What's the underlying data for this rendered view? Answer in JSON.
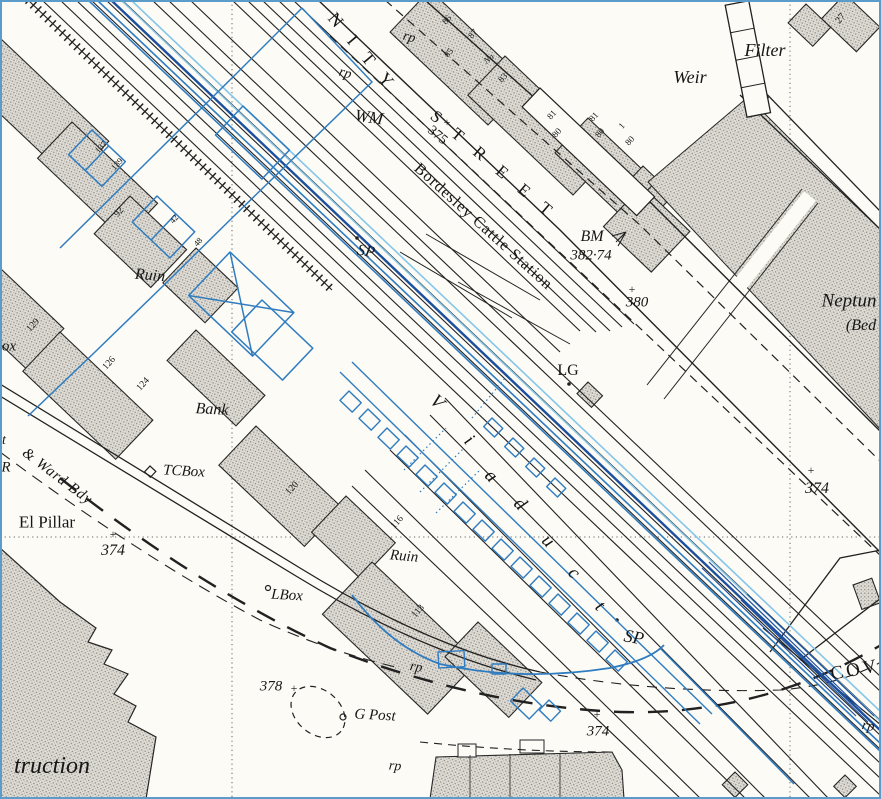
{
  "map": {
    "colors": {
      "paper": "#fcfbf6",
      "ink": "#212121",
      "overlay_blue": "#2f7cc0",
      "overlay_cyan": "#85c6e9",
      "overlay_navy": "#1c4f9d",
      "frame_blue": "#5b9ccb",
      "stipple": "#8e8c84"
    },
    "labels": [
      {
        "id": "street-name-part1",
        "t": "N I T Y",
        "x": 363,
        "y": 52,
        "r": 50,
        "s": 18,
        "i": 0,
        "ls": 6
      },
      {
        "id": "rp-1",
        "t": "rp",
        "x": 409,
        "y": 38,
        "r": 15,
        "s": 14,
        "i": 1
      },
      {
        "id": "rp-2",
        "t": "rp",
        "x": 345,
        "y": 74,
        "r": 15,
        "s": 14,
        "i": 1
      },
      {
        "id": "wm",
        "t": "WM",
        "x": 369,
        "y": 117,
        "r": 8,
        "s": 17,
        "i": 1
      },
      {
        "id": "street-name-part2",
        "t": "S T R E E T",
        "x": 494,
        "y": 165,
        "r": 40,
        "s": 17,
        "i": 0,
        "ls": 7
      },
      {
        "id": "spot-375",
        "t": "375",
        "x": 437,
        "y": 136,
        "r": 40,
        "s": 14,
        "i": 0
      },
      {
        "id": "cross-375",
        "t": "+",
        "x": 447,
        "y": 122,
        "r": 0,
        "s": 12,
        "i": 0
      },
      {
        "id": "bordesley-cattle-station",
        "t": "Bordesley Cattle Station",
        "x": 483,
        "y": 227,
        "r": 42,
        "s": 16,
        "i": 0,
        "ls": 1
      },
      {
        "id": "bm",
        "t": "BM",
        "x": 592,
        "y": 237,
        "r": 0,
        "s": 16,
        "i": 1
      },
      {
        "id": "bm-value",
        "t": "382·74",
        "x": 591,
        "y": 256,
        "r": 0,
        "s": 15,
        "i": 1
      },
      {
        "id": "spot-380",
        "t": "380",
        "x": 637,
        "y": 303,
        "r": 0,
        "s": 15,
        "i": 1
      },
      {
        "id": "cross-380",
        "t": "+",
        "x": 632,
        "y": 289,
        "r": 0,
        "s": 12,
        "i": 0
      },
      {
        "id": "weir",
        "t": "Weir",
        "x": 690,
        "y": 77,
        "r": 0,
        "s": 18,
        "i": 1
      },
      {
        "id": "filter",
        "t": "Filter",
        "x": 765,
        "y": 50,
        "r": 0,
        "s": 18,
        "i": 1
      },
      {
        "id": "no-27",
        "t": "27",
        "x": 841,
        "y": 19,
        "r": -50,
        "s": 10,
        "i": 0
      },
      {
        "id": "no-86",
        "t": "86",
        "x": 447,
        "y": 20,
        "r": -48,
        "s": 9,
        "i": 0
      },
      {
        "id": "no-85",
        "t": "85",
        "x": 449,
        "y": 53,
        "r": -48,
        "s": 9,
        "i": 0
      },
      {
        "id": "no-87",
        "t": "87",
        "x": 473,
        "y": 34,
        "r": -48,
        "s": 9,
        "i": 0
      },
      {
        "id": "no-na",
        "t": "Na",
        "x": 489,
        "y": 59,
        "r": -40,
        "s": 9,
        "i": 1
      },
      {
        "id": "no-83",
        "t": "83",
        "x": 503,
        "y": 78,
        "r": -48,
        "s": 9,
        "i": 0
      },
      {
        "id": "no-81a",
        "t": "81",
        "x": 552,
        "y": 115,
        "r": -48,
        "s": 9,
        "i": 0
      },
      {
        "id": "no-80a",
        "t": "80",
        "x": 557,
        "y": 133,
        "r": -48,
        "s": 9,
        "i": 0
      },
      {
        "id": "no-81b",
        "t": "81",
        "x": 594,
        "y": 117,
        "r": -48,
        "s": 9,
        "i": 0
      },
      {
        "id": "no-80b",
        "t": "80",
        "x": 600,
        "y": 133,
        "r": -48,
        "s": 9,
        "i": 0
      },
      {
        "id": "no-1",
        "t": "1",
        "x": 622,
        "y": 126,
        "r": -48,
        "s": 9,
        "i": 0
      },
      {
        "id": "no-80c",
        "t": "80",
        "x": 630,
        "y": 141,
        "r": -48,
        "s": 9,
        "i": 0
      },
      {
        "id": "neptun",
        "t": "Neptun",
        "x": 849,
        "y": 301,
        "r": 0,
        "s": 19,
        "i": 1
      },
      {
        "id": "bed",
        "t": "(Bed",
        "x": 861,
        "y": 326,
        "r": 0,
        "s": 16,
        "i": 1
      },
      {
        "id": "spot-374-right",
        "t": "374",
        "x": 817,
        "y": 489,
        "r": 0,
        "s": 16,
        "i": 1
      },
      {
        "id": "cross-374-right",
        "t": "+",
        "x": 811,
        "y": 470,
        "r": 0,
        "s": 12,
        "i": 0
      },
      {
        "id": "cov",
        "t": "COV",
        "x": 855,
        "y": 670,
        "r": -10,
        "s": 19,
        "i": 0,
        "ls": 3
      },
      {
        "id": "rp-5",
        "t": "rp",
        "x": 868,
        "y": 727,
        "r": 10,
        "s": 14,
        "i": 1
      },
      {
        "id": "sp-2",
        "t": "SP",
        "x": 634,
        "y": 637,
        "r": 10,
        "s": 18,
        "i": 1
      },
      {
        "id": "viaduct-v",
        "t": "V",
        "x": 437,
        "y": 402,
        "r": 45,
        "s": 19,
        "i": 1
      },
      {
        "id": "viaduct-i",
        "t": "i",
        "x": 469,
        "y": 440,
        "r": 45,
        "s": 19,
        "i": 1
      },
      {
        "id": "viaduct-a",
        "t": "a",
        "x": 491,
        "y": 476,
        "r": 45,
        "s": 19,
        "i": 1
      },
      {
        "id": "viaduct-d",
        "t": "d",
        "x": 520,
        "y": 504,
        "r": 45,
        "s": 19,
        "i": 1
      },
      {
        "id": "viaduct-u",
        "t": "u",
        "x": 548,
        "y": 541,
        "r": 45,
        "s": 19,
        "i": 1
      },
      {
        "id": "viaduct-c",
        "t": "c",
        "x": 574,
        "y": 573,
        "r": 45,
        "s": 19,
        "i": 1
      },
      {
        "id": "viaduct-t",
        "t": "t",
        "x": 600,
        "y": 606,
        "r": 45,
        "s": 19,
        "i": 1
      },
      {
        "id": "sp-1",
        "t": "SP",
        "x": 366,
        "y": 252,
        "r": 10,
        "s": 16,
        "i": 1
      },
      {
        "id": "lg",
        "t": "LG",
        "x": 568,
        "y": 371,
        "r": 0,
        "s": 16,
        "i": 0
      },
      {
        "id": "ruin-1",
        "t": "Ruin",
        "x": 150,
        "y": 276,
        "r": 5,
        "s": 16,
        "i": 1
      },
      {
        "id": "ruin-2",
        "t": "Ruin",
        "x": 404,
        "y": 557,
        "r": 5,
        "s": 15,
        "i": 1
      },
      {
        "id": "bank",
        "t": "Bank",
        "x": 212,
        "y": 410,
        "r": 3,
        "s": 16,
        "i": 1
      },
      {
        "id": "no-129",
        "t": "129",
        "x": 34,
        "y": 326,
        "r": -48,
        "s": 9.5,
        "i": 0
      },
      {
        "id": "no-92",
        "t": "92",
        "x": 120,
        "y": 213,
        "r": -48,
        "s": 9.5,
        "i": 0
      },
      {
        "id": "no-137",
        "t": "137",
        "x": 101,
        "y": 147,
        "r": -48,
        "s": 8.5,
        "i": 0
      },
      {
        "id": "no-139",
        "t": "139",
        "x": 117,
        "y": 164,
        "r": -48,
        "s": 8.5,
        "i": 0
      },
      {
        "id": "no-42",
        "t": "42",
        "x": 174,
        "y": 219,
        "r": -48,
        "s": 8.5,
        "i": 0
      },
      {
        "id": "no-48",
        "t": "48",
        "x": 198,
        "y": 242,
        "r": -48,
        "s": 8.5,
        "i": 0
      },
      {
        "id": "no-126",
        "t": "126",
        "x": 110,
        "y": 364,
        "r": -48,
        "s": 9.5,
        "i": 0
      },
      {
        "id": "no-124",
        "t": "124",
        "x": 144,
        "y": 385,
        "r": -48,
        "s": 9.5,
        "i": 0
      },
      {
        "id": "no-120",
        "t": "120",
        "x": 293,
        "y": 489,
        "r": -48,
        "s": 9.5,
        "i": 0
      },
      {
        "id": "no-116",
        "t": "116",
        "x": 398,
        "y": 523,
        "r": -48,
        "s": 9.5,
        "i": 0
      },
      {
        "id": "no-113",
        "t": "113",
        "x": 419,
        "y": 612,
        "r": -48,
        "s": 9.5,
        "i": 0
      },
      {
        "id": "ox",
        "t": "ox",
        "x": 9,
        "y": 347,
        "r": 0,
        "s": 15,
        "i": 1
      },
      {
        "id": "ward-bdy",
        "t": "& Ward Bdy",
        "x": 57,
        "y": 477,
        "r": 37,
        "s": 15,
        "i": 1,
        "ls": 1
      },
      {
        "id": "t-frag",
        "t": "t",
        "x": 4,
        "y": 441,
        "r": 0,
        "s": 14,
        "i": 1
      },
      {
        "id": "r-frag",
        "t": "R",
        "x": 6,
        "y": 468,
        "r": 0,
        "s": 15,
        "i": 1
      },
      {
        "id": "el-pillar",
        "t": "El Pillar",
        "x": 47,
        "y": 522,
        "r": 0,
        "s": 17,
        "i": 0
      },
      {
        "id": "spot-374-left",
        "t": "374",
        "x": 113,
        "y": 551,
        "r": 0,
        "s": 16,
        "i": 1
      },
      {
        "id": "cross-374-left",
        "t": "+",
        "x": 113,
        "y": 534,
        "r": 0,
        "s": 12,
        "i": 0
      },
      {
        "id": "tcbox",
        "t": "TCBox",
        "x": 184,
        "y": 472,
        "r": 3,
        "s": 15,
        "i": 1
      },
      {
        "id": "lbox",
        "t": "LBox",
        "x": 287,
        "y": 596,
        "r": 3,
        "s": 15,
        "i": 1
      },
      {
        "id": "spot-378",
        "t": "378",
        "x": 271,
        "y": 687,
        "r": 0,
        "s": 15,
        "i": 1
      },
      {
        "id": "cross-378",
        "t": "+",
        "x": 294,
        "y": 688,
        "r": 0,
        "s": 12,
        "i": 0
      },
      {
        "id": "gpost",
        "t": "G Post",
        "x": 375,
        "y": 716,
        "r": 3,
        "s": 15,
        "i": 1
      },
      {
        "id": "spot-374-bottom",
        "t": "374",
        "x": 598,
        "y": 732,
        "r": 0,
        "s": 15,
        "i": 1
      },
      {
        "id": "cross-374-bottom",
        "t": "+",
        "x": 597,
        "y": 714,
        "r": 0,
        "s": 12,
        "i": 0
      },
      {
        "id": "rp-3",
        "t": "rp",
        "x": 416,
        "y": 668,
        "r": 10,
        "s": 14,
        "i": 1
      },
      {
        "id": "rp-4",
        "t": "rp",
        "x": 395,
        "y": 767,
        "r": 5,
        "s": 14,
        "i": 1
      },
      {
        "id": "truction",
        "t": "truction",
        "x": 52,
        "y": 766,
        "r": 0,
        "s": 24,
        "i": 1
      }
    ]
  }
}
